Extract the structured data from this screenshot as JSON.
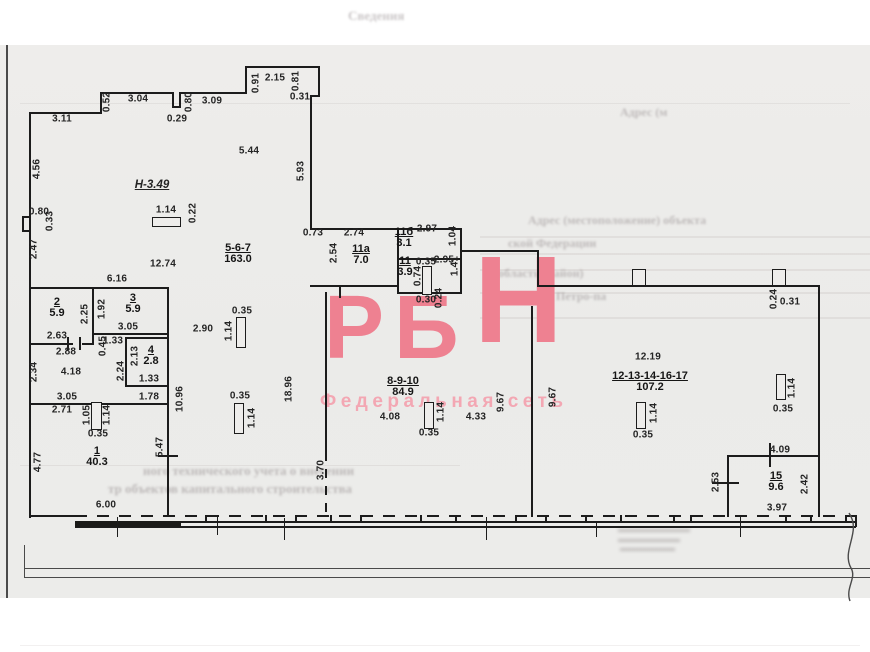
{
  "watermark": {
    "letters": [
      "Р",
      "Б",
      "Н"
    ],
    "subtitle": "Федеральная сеть",
    "color": "#ee8191",
    "subtitle_color": "#f3a7b3"
  },
  "plan": {
    "height_note": "Н-3.49",
    "rooms": [
      {
        "label": "5-6-7",
        "area": "163.0",
        "x": 238,
        "y": 243
      },
      {
        "label": "11а",
        "area": "7.0",
        "x": 361,
        "y": 244
      },
      {
        "label": "11б",
        "area": "3.1",
        "x": 404,
        "y": 227
      },
      {
        "label": "11",
        "area": "3.9",
        "x": 405,
        "y": 256
      },
      {
        "label": "8-9-10",
        "area": "84.9",
        "x": 403,
        "y": 376
      },
      {
        "label": "12-13-14-16-17",
        "area": "107.2",
        "x": 650,
        "y": 371
      },
      {
        "label": "15",
        "area": "9.6",
        "x": 776,
        "y": 471
      },
      {
        "label": "1",
        "area": "40.3",
        "x": 97,
        "y": 446
      },
      {
        "label": "2",
        "area": "5.9",
        "x": 57,
        "y": 297
      },
      {
        "label": "3",
        "area": "5.9",
        "x": 133,
        "y": 293
      },
      {
        "label": "4",
        "area": "2.8",
        "x": 151,
        "y": 345
      }
    ],
    "dims": [
      {
        "t": "3.11",
        "x": 62,
        "y": 119
      },
      {
        "t": "0.52",
        "x": 107,
        "y": 102,
        "v": true
      },
      {
        "t": "3.04",
        "x": 138,
        "y": 99
      },
      {
        "t": "0.29",
        "x": 177,
        "y": 119
      },
      {
        "t": "0.80",
        "x": 189,
        "y": 102,
        "v": true
      },
      {
        "t": "3.09",
        "x": 212,
        "y": 101
      },
      {
        "t": "0.91",
        "x": 256,
        "y": 83,
        "v": true
      },
      {
        "t": "2.15",
        "x": 275,
        "y": 78
      },
      {
        "t": "0.81",
        "x": 296,
        "y": 81,
        "v": true
      },
      {
        "t": "0.31",
        "x": 300,
        "y": 97
      },
      {
        "t": "5.93",
        "x": 301,
        "y": 171,
        "v": true
      },
      {
        "t": "4.56",
        "x": 37,
        "y": 169,
        "v": true
      },
      {
        "t": "0.80",
        "x": 39,
        "y": 212
      },
      {
        "t": "0.33",
        "x": 50,
        "y": 221,
        "v": true
      },
      {
        "t": "2.47",
        "x": 34,
        "y": 249,
        "v": true
      },
      {
        "t": "2.34",
        "x": 34,
        "y": 372,
        "v": true
      },
      {
        "t": "4.77",
        "x": 38,
        "y": 462,
        "v": true
      },
      {
        "t": "5.44",
        "x": 249,
        "y": 151
      },
      {
        "t": "1.14",
        "x": 166,
        "y": 210
      },
      {
        "t": "0.22",
        "x": 193,
        "y": 213,
        "v": true
      },
      {
        "t": "12.74",
        "x": 163,
        "y": 264
      },
      {
        "t": "6.16",
        "x": 117,
        "y": 279
      },
      {
        "t": "2.90",
        "x": 203,
        "y": 329
      },
      {
        "t": "0.35",
        "x": 242,
        "y": 311
      },
      {
        "t": "1.14",
        "x": 229,
        "y": 331,
        "v": true
      },
      {
        "t": "0.35",
        "x": 240,
        "y": 396
      },
      {
        "t": "1.14",
        "x": 252,
        "y": 418,
        "v": true
      },
      {
        "t": "18.96",
        "x": 289,
        "y": 389,
        "v": true
      },
      {
        "t": "10.96",
        "x": 180,
        "y": 399,
        "v": true
      },
      {
        "t": "5.47",
        "x": 160,
        "y": 447,
        "v": true
      },
      {
        "t": "6.00",
        "x": 106,
        "y": 505
      },
      {
        "t": "4.18",
        "x": 71,
        "y": 372
      },
      {
        "t": "3.05",
        "x": 67,
        "y": 397
      },
      {
        "t": "2.71",
        "x": 62,
        "y": 410
      },
      {
        "t": "1.05",
        "x": 87,
        "y": 415,
        "v": true
      },
      {
        "t": "1.14",
        "x": 107,
        "y": 415,
        "v": true
      },
      {
        "t": "0.35",
        "x": 98,
        "y": 434
      },
      {
        "t": "2.25",
        "x": 85,
        "y": 314,
        "v": true
      },
      {
        "t": "2.63",
        "x": 57,
        "y": 336
      },
      {
        "t": "2.88",
        "x": 66,
        "y": 352
      },
      {
        "t": "1.92",
        "x": 102,
        "y": 309,
        "v": true
      },
      {
        "t": "3.05",
        "x": 128,
        "y": 327
      },
      {
        "t": "2.13",
        "x": 135,
        "y": 356,
        "v": true
      },
      {
        "t": "1.33",
        "x": 149,
        "y": 379
      },
      {
        "t": "2.24",
        "x": 121,
        "y": 371,
        "v": true
      },
      {
        "t": "1.78",
        "x": 149,
        "y": 397
      },
      {
        "t": "1.33",
        "x": 113,
        "y": 341
      },
      {
        "t": "0.45",
        "x": 103,
        "y": 346,
        "v": true
      },
      {
        "t": "0.73",
        "x": 313,
        "y": 233
      },
      {
        "t": "2.74",
        "x": 354,
        "y": 233
      },
      {
        "t": "2.54",
        "x": 334,
        "y": 253,
        "v": true
      },
      {
        "t": "2.97",
        "x": 427,
        "y": 229
      },
      {
        "t": "1.04",
        "x": 453,
        "y": 236,
        "v": true
      },
      {
        "t": "0.35",
        "x": 426,
        "y": 262
      },
      {
        "t": "2.95",
        "x": 444,
        "y": 260
      },
      {
        "t": "1.41",
        "x": 455,
        "y": 266,
        "v": true
      },
      {
        "t": "0.74",
        "x": 418,
        "y": 276,
        "v": true
      },
      {
        "t": "0.30",
        "x": 426,
        "y": 300
      },
      {
        "t": "0.24",
        "x": 439,
        "y": 298,
        "v": true
      },
      {
        "t": "4.08",
        "x": 390,
        "y": 417
      },
      {
        "t": "1.14",
        "x": 441,
        "y": 412,
        "v": true
      },
      {
        "t": "0.35",
        "x": 429,
        "y": 433
      },
      {
        "t": "4.33",
        "x": 476,
        "y": 417
      },
      {
        "t": "9.67",
        "x": 501,
        "y": 402,
        "v": true
      },
      {
        "t": "9.67",
        "x": 553,
        "y": 397,
        "v": true
      },
      {
        "t": "3.70",
        "x": 321,
        "y": 470,
        "v": true
      },
      {
        "t": "0.24",
        "x": 774,
        "y": 299,
        "v": true
      },
      {
        "t": "0.31",
        "x": 790,
        "y": 302
      },
      {
        "t": "12.19",
        "x": 648,
        "y": 357
      },
      {
        "t": "1.14",
        "x": 654,
        "y": 413,
        "v": true
      },
      {
        "t": "0.35",
        "x": 643,
        "y": 435
      },
      {
        "t": "1.14",
        "x": 792,
        "y": 388,
        "v": true
      },
      {
        "t": "0.35",
        "x": 783,
        "y": 409
      },
      {
        "t": "4.09",
        "x": 780,
        "y": 450
      },
      {
        "t": "2.53",
        "x": 716,
        "y": 482,
        "v": true
      },
      {
        "t": "2.42",
        "x": 805,
        "y": 484,
        "v": true
      },
      {
        "t": "3.97",
        "x": 777,
        "y": 508
      }
    ]
  },
  "bleedthrough": {
    "lines": [
      {
        "t": "Сведения",
        "x": 348,
        "y": 8,
        "fs": 13
      },
      {
        "t": "Адрес (м",
        "x": 620,
        "y": 105,
        "fs": 12
      },
      {
        "t": "Адрес (местоположение) объекта",
        "x": 528,
        "y": 213,
        "fs": 12
      },
      {
        "t": "ской Федерации",
        "x": 508,
        "y": 236,
        "fs": 12
      },
      {
        "t": "область (район)",
        "x": 498,
        "y": 266,
        "fs": 12
      },
      {
        "t": "Петро-па",
        "x": 556,
        "y": 289,
        "fs": 12
      },
      {
        "t": "ного технического учета о внесении",
        "x": 143,
        "y": 463,
        "fs": 13
      },
      {
        "t": "тр объектов капитального строительства",
        "x": 108,
        "y": 481,
        "fs": 13
      }
    ]
  }
}
